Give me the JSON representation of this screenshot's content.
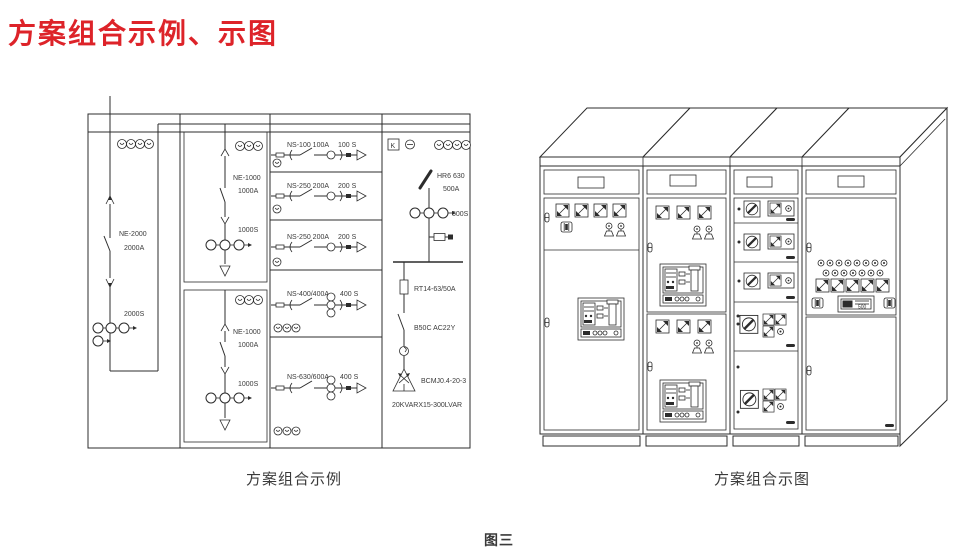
{
  "page": {
    "title": "方案组合示例、示图",
    "figure_label": "图三"
  },
  "schematic": {
    "caption": "方案组合示例",
    "incoming": {
      "model": "NE-2000",
      "rating": "2000A",
      "ct": "2000S"
    },
    "tie_top": {
      "model": "NE-1000",
      "rating": "1000A",
      "ct": "1000S"
    },
    "tie_bottom": {
      "model": "NE-1000",
      "rating": "1000A",
      "ct": "1000S"
    },
    "feeders": [
      {
        "model": "NS-100  100A",
        "ct": "100 S"
      },
      {
        "model": "NS-250  200A",
        "ct": "200 S"
      },
      {
        "model": "NS-250  200A",
        "ct": "200 S"
      },
      {
        "model": "NS-400/400A",
        "ct": "400 S"
      },
      {
        "model": "NS-630/600A",
        "ct": "400 S"
      }
    ],
    "compensation": {
      "k_label": "K",
      "switch_model": "HR6 630",
      "switch_rating": "500A",
      "ct": "500S",
      "fuse": "RT14-63/50A",
      "contactor": "B50C  AC22Y",
      "capacitor": "BCMJ0.4-20-3",
      "bank_total": "20KVARX15-300LVAR"
    }
  },
  "cabinet_view": {
    "caption": "方案组合示图",
    "controller_display": "500"
  },
  "colors": {
    "title_red": "#dd2329",
    "line": "#2c2c2c"
  }
}
